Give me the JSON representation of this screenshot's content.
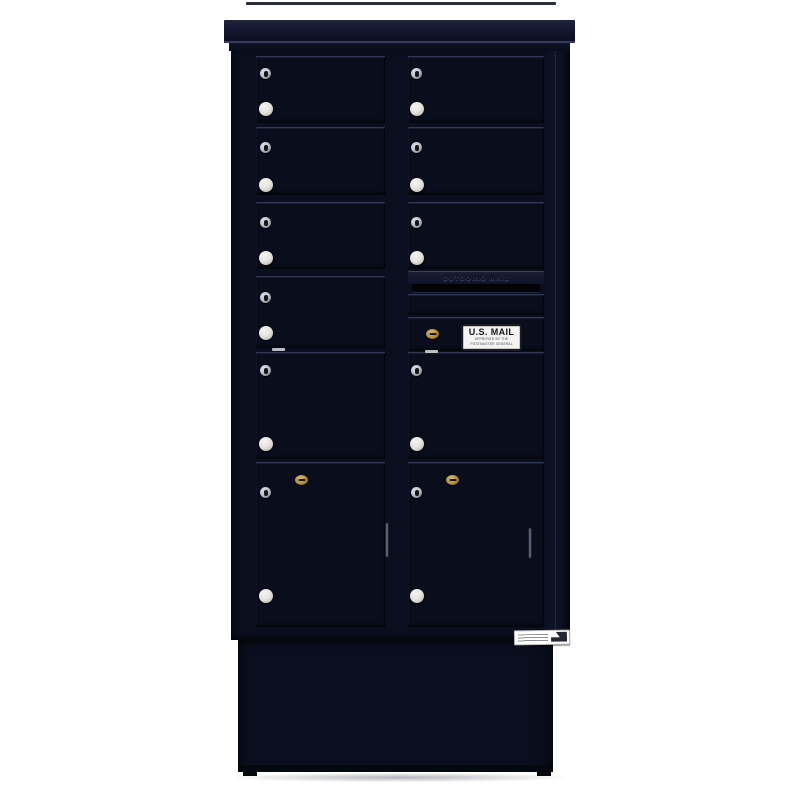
{
  "scene": {
    "type": "product-photo",
    "background": "#ffffff"
  },
  "colors": {
    "background": "#ffffff",
    "cabinet": "#0b0e1e",
    "cabinetDark": "#070a15",
    "door": "#0a0d1c",
    "crown": "#1a1e33",
    "slot": "#04050b",
    "knob": "#e8e5e0",
    "silver": "#c6c6cd",
    "gold": "#b5923f",
    "decalBg": "#f4f3f0",
    "decalInk": "#14161f",
    "labelBg": "#ffffff"
  },
  "cabinet": {
    "finish": "black",
    "columns": 2,
    "door_counts": {
      "standard": 7,
      "medium": 2,
      "parcel": 2,
      "collection": 1
    },
    "outgoing_plate": {
      "label": "OUTGOING MAIL"
    },
    "decal": {
      "line1": "U.S. MAIL",
      "line2": "APPROVED BY THE",
      "line3": "POSTMASTER GENERAL"
    }
  }
}
